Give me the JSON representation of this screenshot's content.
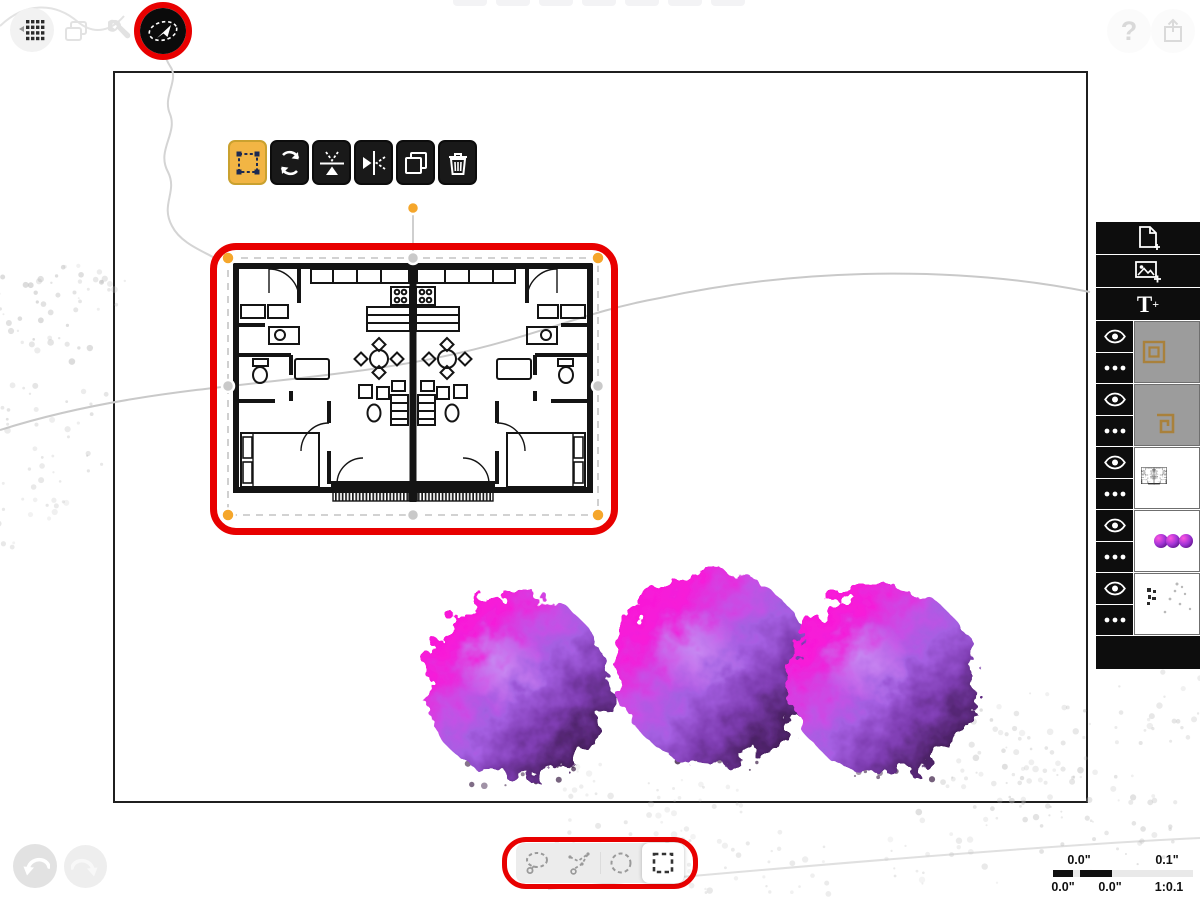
{
  "topbar": {
    "help_label": "?",
    "left_buttons": [
      {
        "name": "grid-menu-icon"
      },
      {
        "name": "pages-icon"
      },
      {
        "name": "wrench-icon"
      },
      {
        "name": "move-tool-icon",
        "active": true,
        "annotated": true
      }
    ],
    "right_buttons": [
      {
        "name": "help-button"
      },
      {
        "name": "share-icon"
      }
    ]
  },
  "selection_toolbar": {
    "buttons": [
      {
        "name": "transform",
        "active": true
      },
      {
        "name": "rotate",
        "active": false
      },
      {
        "name": "flip-vertical",
        "active": false
      },
      {
        "name": "flip-horizontal",
        "active": false
      },
      {
        "name": "duplicate",
        "active": false
      },
      {
        "name": "delete",
        "active": false
      }
    ]
  },
  "marquee_tools": {
    "annotated": true,
    "tools": [
      {
        "name": "lasso",
        "active": false
      },
      {
        "name": "polygon-lasso",
        "active": false
      },
      {
        "name": "ellipse-select",
        "active": false
      },
      {
        "name": "rectangle-select",
        "active": true
      }
    ]
  },
  "sidebar": {
    "buttons": [
      {
        "name": "add-page-button"
      },
      {
        "name": "add-image-button"
      },
      {
        "name": "add-text-button",
        "label": "T",
        "plus": "+"
      }
    ],
    "layers": [
      {
        "name": "layer-stencil-frame",
        "visible": true,
        "thumb": "gray-square-outline"
      },
      {
        "name": "layer-stencil-spiral",
        "visible": true,
        "thumb": "gray-spiral"
      },
      {
        "name": "layer-floor-plan",
        "visible": true,
        "thumb": "floor-plan-mini"
      },
      {
        "name": "layer-trees",
        "visible": true,
        "thumb": "three-purple-dots"
      },
      {
        "name": "layer-site-sketch",
        "visible": true,
        "thumb": "gray-sketch"
      }
    ]
  },
  "history": {
    "undo_enabled": true,
    "redo_enabled": false
  },
  "scale_bar": {
    "top_labels": [
      "0.0\"",
      "0.1\""
    ],
    "bottom_labels": [
      "0.0\"",
      "0.0\"",
      "1:0.1"
    ]
  },
  "colors": {
    "annotation_red": "#e80000",
    "accent_orange": "#f2b544",
    "handle_orange": "#f5a62b",
    "tree_magenta": "#ff14d3",
    "tree_dark_purple": "#231028"
  }
}
